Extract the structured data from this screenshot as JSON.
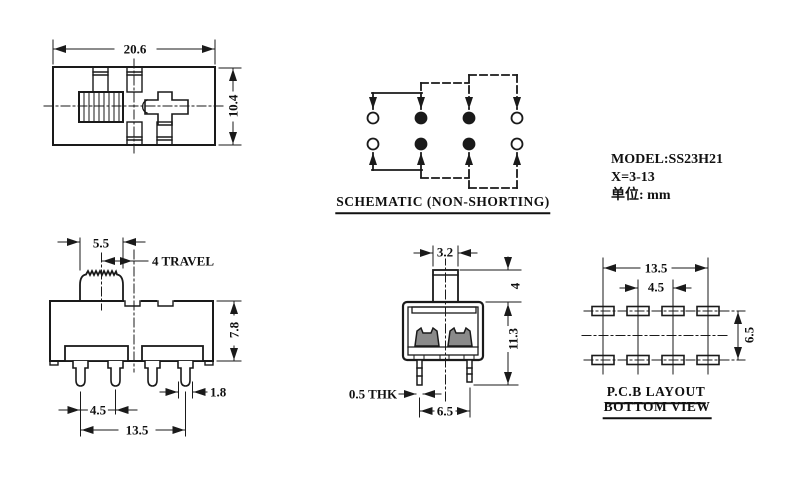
{
  "colors": {
    "line": "#1a1a1a",
    "background": "#ffffff"
  },
  "top_view": {
    "width": "20.6",
    "height": "10.4"
  },
  "schematic": {
    "label": "SCHEMATIC (NON-SHORTING)"
  },
  "info": {
    "model": "MODEL:SS23H21",
    "travel_range": "X=3-13",
    "unit": "单位: mm"
  },
  "front_view": {
    "knob_width": "5.5",
    "travel": "4 TRAVEL",
    "body_height": "7.8",
    "pin_width": "1.8",
    "pin_pitch": "4.5",
    "pin_span": "13.5"
  },
  "side_view": {
    "knob_width": "3.2",
    "knob_height": "4",
    "height": "11.3",
    "pin_thickness": "0.5 THK",
    "pin_pitch": "6.5"
  },
  "pcb_view": {
    "span": "13.5",
    "pitch": "4.5",
    "row_pitch": "6.5",
    "label_line1": "P.C.B LAYOUT",
    "label_line2": "BOTTOM VIEW"
  }
}
